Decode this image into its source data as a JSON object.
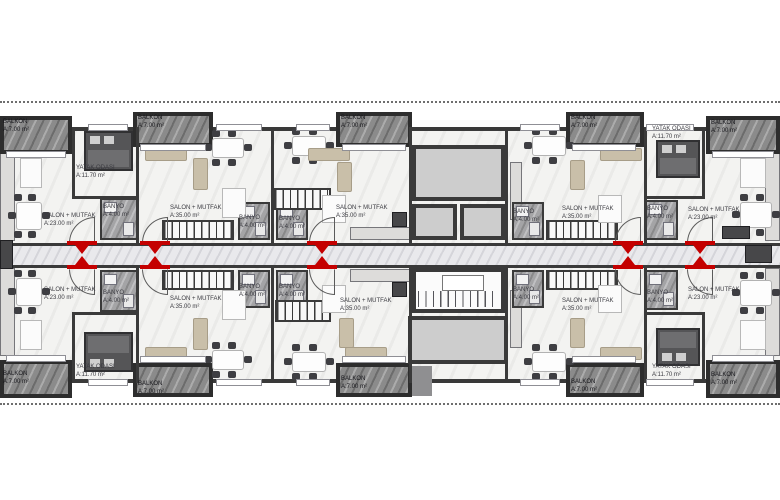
{
  "drawing": {
    "kind": "architectural-floor-plan",
    "units_visible": 10,
    "background": "#ffffff"
  },
  "labels": {
    "balkon": "BALKON",
    "balkon_area": "A:7.00 m²",
    "salon": "SALON + MUTFAK",
    "salon23_area": "A:23.00 m²",
    "salon35_area": "A:35.00 m²",
    "yatak": "YATAK ODASI",
    "yatak_area": "A:11.70 m²",
    "banyo": "BANYO",
    "banyo_area": "A:4.00 m²"
  },
  "colors": {
    "wall": "#3a3a3a",
    "balcony_marble": "#8b8b8b",
    "core_room": "#cdcdcd",
    "entrance_marker_red": "#c40000",
    "floor": "#f3f3f1",
    "corridor": "#e9e9ec",
    "bath_tile": "#a4a4a6"
  },
  "dotted_lines": [
    {
      "y": 101
    },
    {
      "y": 403
    }
  ],
  "balconies": [
    {
      "x": 0,
      "y": 116,
      "w": 72,
      "h": 38,
      "lx": 3,
      "ly": 119
    },
    {
      "x": 133,
      "y": 112,
      "w": 80,
      "h": 35,
      "lx": 138,
      "ly": 115
    },
    {
      "x": 336,
      "y": 112,
      "w": 76,
      "h": 35,
      "lx": 341,
      "ly": 115
    },
    {
      "x": 566,
      "y": 112,
      "w": 78,
      "h": 35,
      "lx": 571,
      "ly": 115
    },
    {
      "x": 706,
      "y": 116,
      "w": 74,
      "h": 38,
      "lx": 711,
      "ly": 120
    },
    {
      "x": 0,
      "y": 360,
      "w": 72,
      "h": 38,
      "lx": 3,
      "ly": 371
    },
    {
      "x": 133,
      "y": 363,
      "w": 80,
      "h": 34,
      "lx": 138,
      "ly": 381
    },
    {
      "x": 336,
      "y": 363,
      "w": 76,
      "h": 34,
      "lx": 341,
      "ly": 376
    },
    {
      "x": 566,
      "y": 363,
      "w": 78,
      "h": 34,
      "lx": 571,
      "ly": 379
    },
    {
      "x": 706,
      "y": 360,
      "w": 74,
      "h": 38,
      "lx": 711,
      "ly": 372
    }
  ],
  "room_labels": [
    {
      "t": "salon23",
      "x": 44,
      "y": 213
    },
    {
      "t": "salon35",
      "x": 170,
      "y": 205
    },
    {
      "t": "salon35",
      "x": 336,
      "y": 205
    },
    {
      "t": "salon35",
      "x": 562,
      "y": 206
    },
    {
      "t": "salon23",
      "x": 688,
      "y": 207
    },
    {
      "t": "salon23",
      "x": 44,
      "y": 287
    },
    {
      "t": "salon35",
      "x": 170,
      "y": 296
    },
    {
      "t": "salon35",
      "x": 340,
      "y": 298
    },
    {
      "t": "salon35",
      "x": 562,
      "y": 298
    },
    {
      "t": "salon23",
      "x": 688,
      "y": 287
    },
    {
      "t": "yatak",
      "x": 76,
      "y": 165
    },
    {
      "t": "yatak",
      "x": 652,
      "y": 126
    },
    {
      "t": "yatak",
      "x": 76,
      "y": 364
    },
    {
      "t": "yatak",
      "x": 652,
      "y": 364
    },
    {
      "t": "banyo",
      "x": 103,
      "y": 204
    },
    {
      "t": "banyo",
      "x": 239,
      "y": 215
    },
    {
      "t": "banyo",
      "x": 279,
      "y": 216
    },
    {
      "t": "banyo",
      "x": 513,
      "y": 209
    },
    {
      "t": "banyo",
      "x": 647,
      "y": 206
    },
    {
      "t": "banyo",
      "x": 103,
      "y": 290
    },
    {
      "t": "banyo",
      "x": 239,
      "y": 284
    },
    {
      "t": "banyo",
      "x": 279,
      "y": 284
    },
    {
      "t": "banyo",
      "x": 513,
      "y": 287
    },
    {
      "t": "banyo",
      "x": 647,
      "y": 290
    }
  ],
  "bathrooms": [
    {
      "x": 100,
      "y": 198,
      "w": 38,
      "h": 42
    },
    {
      "x": 238,
      "y": 202,
      "w": 32,
      "h": 38
    },
    {
      "x": 276,
      "y": 202,
      "w": 32,
      "h": 38
    },
    {
      "x": 512,
      "y": 202,
      "w": 32,
      "h": 38
    },
    {
      "x": 645,
      "y": 200,
      "w": 33,
      "h": 40
    },
    {
      "x": 100,
      "y": 270,
      "w": 38,
      "h": 42
    },
    {
      "x": 238,
      "y": 270,
      "w": 32,
      "h": 38
    },
    {
      "x": 276,
      "y": 270,
      "w": 32,
      "h": 38
    },
    {
      "x": 512,
      "y": 270,
      "w": 32,
      "h": 38
    },
    {
      "x": 645,
      "y": 270,
      "w": 33,
      "h": 40
    }
  ],
  "beds": [
    {
      "x": 84,
      "y": 131,
      "w": 49,
      "h": 40,
      "flip": 0
    },
    {
      "x": 656,
      "y": 140,
      "w": 44,
      "h": 38,
      "flip": 0
    },
    {
      "x": 84,
      "y": 332,
      "w": 49,
      "h": 40,
      "flip": 1
    },
    {
      "x": 656,
      "y": 328,
      "w": 44,
      "h": 38,
      "flip": 1
    }
  ],
  "stairs": [
    {
      "x": 162,
      "y": 220,
      "w": 72,
      "h": 20
    },
    {
      "x": 546,
      "y": 220,
      "w": 72,
      "h": 20
    },
    {
      "x": 273,
      "y": 188,
      "w": 58,
      "h": 22
    },
    {
      "x": 162,
      "y": 270,
      "w": 72,
      "h": 20
    },
    {
      "x": 546,
      "y": 270,
      "w": 72,
      "h": 20
    },
    {
      "x": 275,
      "y": 300,
      "w": 56,
      "h": 22
    }
  ],
  "tables": [
    {
      "x": 10,
      "y": 196,
      "w": 38,
      "h": 40
    },
    {
      "x": 206,
      "y": 132,
      "w": 44,
      "h": 32
    },
    {
      "x": 286,
      "y": 130,
      "w": 46,
      "h": 32
    },
    {
      "x": 526,
      "y": 130,
      "w": 46,
      "h": 32
    },
    {
      "x": 734,
      "y": 196,
      "w": 44,
      "h": 38
    },
    {
      "x": 10,
      "y": 272,
      "w": 38,
      "h": 40
    },
    {
      "x": 206,
      "y": 344,
      "w": 44,
      "h": 32
    },
    {
      "x": 286,
      "y": 346,
      "w": 46,
      "h": 32
    },
    {
      "x": 526,
      "y": 346,
      "w": 46,
      "h": 32
    },
    {
      "x": 734,
      "y": 274,
      "w": 44,
      "h": 38
    }
  ],
  "sofas": [
    {
      "x": 145,
      "y": 148,
      "w": 42,
      "h": 13
    },
    {
      "x": 193,
      "y": 158,
      "w": 15,
      "h": 32
    },
    {
      "x": 308,
      "y": 148,
      "w": 42,
      "h": 13
    },
    {
      "x": 337,
      "y": 162,
      "w": 15,
      "h": 30
    },
    {
      "x": 600,
      "y": 148,
      "w": 42,
      "h": 13
    },
    {
      "x": 570,
      "y": 160,
      "w": 15,
      "h": 30
    },
    {
      "x": 145,
      "y": 347,
      "w": 42,
      "h": 13
    },
    {
      "x": 193,
      "y": 318,
      "w": 15,
      "h": 32
    },
    {
      "x": 345,
      "y": 347,
      "w": 42,
      "h": 13
    },
    {
      "x": 339,
      "y": 318,
      "w": 15,
      "h": 30
    },
    {
      "x": 600,
      "y": 347,
      "w": 42,
      "h": 13
    },
    {
      "x": 570,
      "y": 318,
      "w": 15,
      "h": 30
    }
  ],
  "whiteboxes": [
    {
      "x": 222,
      "y": 188,
      "w": 24,
      "h": 30
    },
    {
      "x": 322,
      "y": 195,
      "w": 24,
      "h": 28
    },
    {
      "x": 598,
      "y": 195,
      "w": 24,
      "h": 28
    },
    {
      "x": 222,
      "y": 290,
      "w": 24,
      "h": 30
    },
    {
      "x": 322,
      "y": 285,
      "w": 24,
      "h": 28
    },
    {
      "x": 598,
      "y": 285,
      "w": 24,
      "h": 28
    },
    {
      "x": 20,
      "y": 158,
      "w": 22,
      "h": 30
    },
    {
      "x": 740,
      "y": 158,
      "w": 26,
      "h": 30
    },
    {
      "x": 20,
      "y": 320,
      "w": 22,
      "h": 30
    },
    {
      "x": 740,
      "y": 320,
      "w": 26,
      "h": 30
    }
  ],
  "counters": [
    {
      "x": 0,
      "y": 153,
      "w": 15,
      "h": 88
    },
    {
      "x": 0,
      "y": 268,
      "w": 15,
      "h": 88
    },
    {
      "x": 765,
      "y": 153,
      "w": 15,
      "h": 88
    },
    {
      "x": 765,
      "y": 268,
      "w": 15,
      "h": 88
    },
    {
      "x": 350,
      "y": 227,
      "w": 60,
      "h": 13
    },
    {
      "x": 350,
      "y": 269,
      "w": 60,
      "h": 13
    },
    {
      "x": 510,
      "y": 162,
      "w": 12,
      "h": 58
    },
    {
      "x": 510,
      "y": 290,
      "w": 12,
      "h": 58
    }
  ],
  "appliances": [
    {
      "x": 0,
      "y": 240,
      "w": 13,
      "h": 29
    },
    {
      "x": 722,
      "y": 226,
      "w": 28,
      "h": 13
    },
    {
      "x": 392,
      "y": 212,
      "w": 15,
      "h": 15
    },
    {
      "x": 392,
      "y": 282,
      "w": 15,
      "h": 15
    },
    {
      "x": 745,
      "y": 245,
      "w": 27,
      "h": 18
    }
  ],
  "entrance_markers": [
    {
      "cx": 82
    },
    {
      "cx": 155
    },
    {
      "cx": 322
    },
    {
      "cx": 628
    },
    {
      "cx": 700
    }
  ],
  "walls": [
    {
      "x": 136,
      "y": 127,
      "w": 3,
      "h": 116
    },
    {
      "x": 271,
      "y": 127,
      "w": 3,
      "h": 116
    },
    {
      "x": 644,
      "y": 127,
      "w": 3,
      "h": 116
    },
    {
      "x": 136,
      "y": 267,
      "w": 3,
      "h": 116
    },
    {
      "x": 271,
      "y": 267,
      "w": 3,
      "h": 116
    },
    {
      "x": 644,
      "y": 267,
      "w": 3,
      "h": 116
    },
    {
      "x": 72,
      "y": 127,
      "w": 3,
      "h": 72
    },
    {
      "x": 72,
      "y": 196,
      "w": 66,
      "h": 3
    },
    {
      "x": 702,
      "y": 127,
      "w": 3,
      "h": 72
    },
    {
      "x": 644,
      "y": 196,
      "w": 61,
      "h": 3
    },
    {
      "x": 72,
      "y": 312,
      "w": 3,
      "h": 71
    },
    {
      "x": 72,
      "y": 312,
      "w": 66,
      "h": 3
    },
    {
      "x": 702,
      "y": 312,
      "w": 3,
      "h": 71
    },
    {
      "x": 644,
      "y": 312,
      "w": 61,
      "h": 3
    },
    {
      "x": 409,
      "y": 127,
      "w": 3,
      "h": 116
    },
    {
      "x": 505,
      "y": 127,
      "w": 3,
      "h": 116
    },
    {
      "x": 409,
      "y": 267,
      "w": 3,
      "h": 116
    },
    {
      "x": 505,
      "y": 267,
      "w": 3,
      "h": 116
    }
  ],
  "windows": [
    {
      "x": 88,
      "y": 124,
      "w": 40
    },
    {
      "x": 216,
      "y": 124,
      "w": 46
    },
    {
      "x": 296,
      "y": 124,
      "w": 34
    },
    {
      "x": 520,
      "y": 124,
      "w": 40
    },
    {
      "x": 646,
      "y": 124,
      "w": 48
    },
    {
      "x": 88,
      "y": 379,
      "w": 40
    },
    {
      "x": 216,
      "y": 379,
      "w": 46
    },
    {
      "x": 296,
      "y": 379,
      "w": 34
    },
    {
      "x": 520,
      "y": 379,
      "w": 40
    },
    {
      "x": 646,
      "y": 379,
      "w": 48
    },
    {
      "x": 140,
      "y": 144,
      "w": 66
    },
    {
      "x": 342,
      "y": 144,
      "w": 64
    },
    {
      "x": 572,
      "y": 144,
      "w": 64
    },
    {
      "x": 140,
      "y": 356,
      "w": 66
    },
    {
      "x": 342,
      "y": 356,
      "w": 64
    },
    {
      "x": 572,
      "y": 356,
      "w": 64
    },
    {
      "x": 6,
      "y": 151,
      "w": 60
    },
    {
      "x": 712,
      "y": 151,
      "w": 62
    },
    {
      "x": 6,
      "y": 355,
      "w": 60
    },
    {
      "x": 712,
      "y": 355,
      "w": 62
    }
  ],
  "core": {
    "top_room": {
      "x": 412,
      "y": 145,
      "w": 93,
      "h": 56
    },
    "shaft_left": {
      "x": 412,
      "y": 204,
      "w": 45,
      "h": 36
    },
    "shaft_right": {
      "x": 460,
      "y": 204,
      "w": 45,
      "h": 36
    },
    "stairwell": {
      "x": 412,
      "y": 268,
      "w": 93,
      "h": 45
    },
    "bottom_room": {
      "x": 408,
      "y": 316,
      "w": 100,
      "h": 48
    },
    "pad": {
      "x": 412,
      "y": 366,
      "w": 20,
      "h": 30
    }
  }
}
